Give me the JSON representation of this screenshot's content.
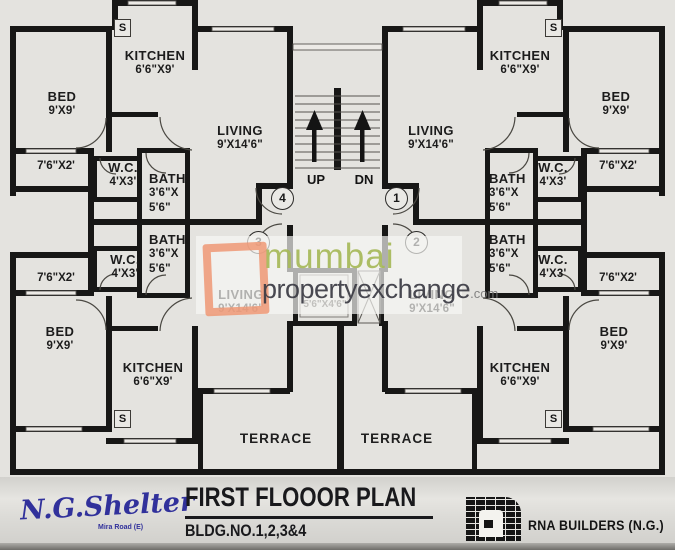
{
  "plan": {
    "flats": [
      {
        "id": "4",
        "position": "upper-left",
        "bed": {
          "name": "BED",
          "dim": "9'X9'"
        },
        "kitchen": {
          "name": "KITCHEN",
          "dim": "6'6\"X9'"
        },
        "living": {
          "name": "LIVING",
          "dim": "9'X14'6\""
        },
        "wc": {
          "name": "W.C.",
          "dim": "4'X3'"
        },
        "bath": {
          "name": "BATH",
          "dim1": "3'6\"X",
          "dim2": "5'6\""
        },
        "balcony": "7'6\"X2'",
        "shaft": "S"
      },
      {
        "id": "1",
        "position": "upper-right",
        "bed": {
          "name": "BED",
          "dim": "9'X9'"
        },
        "kitchen": {
          "name": "KITCHEN",
          "dim": "6'6\"X9'"
        },
        "living": {
          "name": "LIVING",
          "dim": "9'X14'6\""
        },
        "wc": {
          "name": "W.C.",
          "dim": "4'X3'"
        },
        "bath": {
          "name": "BATH",
          "dim1": "3'6\"X",
          "dim2": "5'6\""
        },
        "balcony": "7'6\"X2'",
        "shaft": "S"
      },
      {
        "id": "3",
        "position": "lower-left",
        "bed": {
          "name": "BED",
          "dim": "9'X9'"
        },
        "kitchen": {
          "name": "KITCHEN",
          "dim": "6'6\"X9'"
        },
        "living": {
          "name": "LIVING",
          "dim": "9'X14'6\""
        },
        "wc": {
          "name": "W.C.",
          "dim": "4'X3'"
        },
        "bath": {
          "name": "BATH",
          "dim1": "3'6\"X",
          "dim2": "5'6\""
        },
        "balcony": "7'6\"X2'",
        "shaft": "S",
        "terrace": "TERRACE"
      },
      {
        "id": "2",
        "position": "lower-right",
        "bed": {
          "name": "BED",
          "dim": "9'X9'"
        },
        "kitchen": {
          "name": "KITCHEN",
          "dim": "6'6\"X9'"
        },
        "living": {
          "name": "LIVING",
          "dim": "9'X14'6\""
        },
        "wc": {
          "name": "W.C.",
          "dim": "4'X3'"
        },
        "bath": {
          "name": "BATH",
          "dim1": "3'6\"X",
          "dim2": "5'6\""
        },
        "balcony": "7'6\"X2'",
        "shaft": "S",
        "terrace": "TERRACE"
      }
    ],
    "core": {
      "up": "UP",
      "down": "DN",
      "lift_dim": "5'6\"X4'6\""
    }
  },
  "watermark": {
    "line1": "mumbai",
    "line2": "propertyexchange",
    "suffix": ".com"
  },
  "footer": {
    "brand": "N.G.Shelter",
    "brand_sub": "Mira Road (E)",
    "title": "FIRST FLOOOR PLAN",
    "subtitle": "BLDG.NO.1,2,3&4",
    "builder": "RNA BUILDERS (N.G.)"
  }
}
